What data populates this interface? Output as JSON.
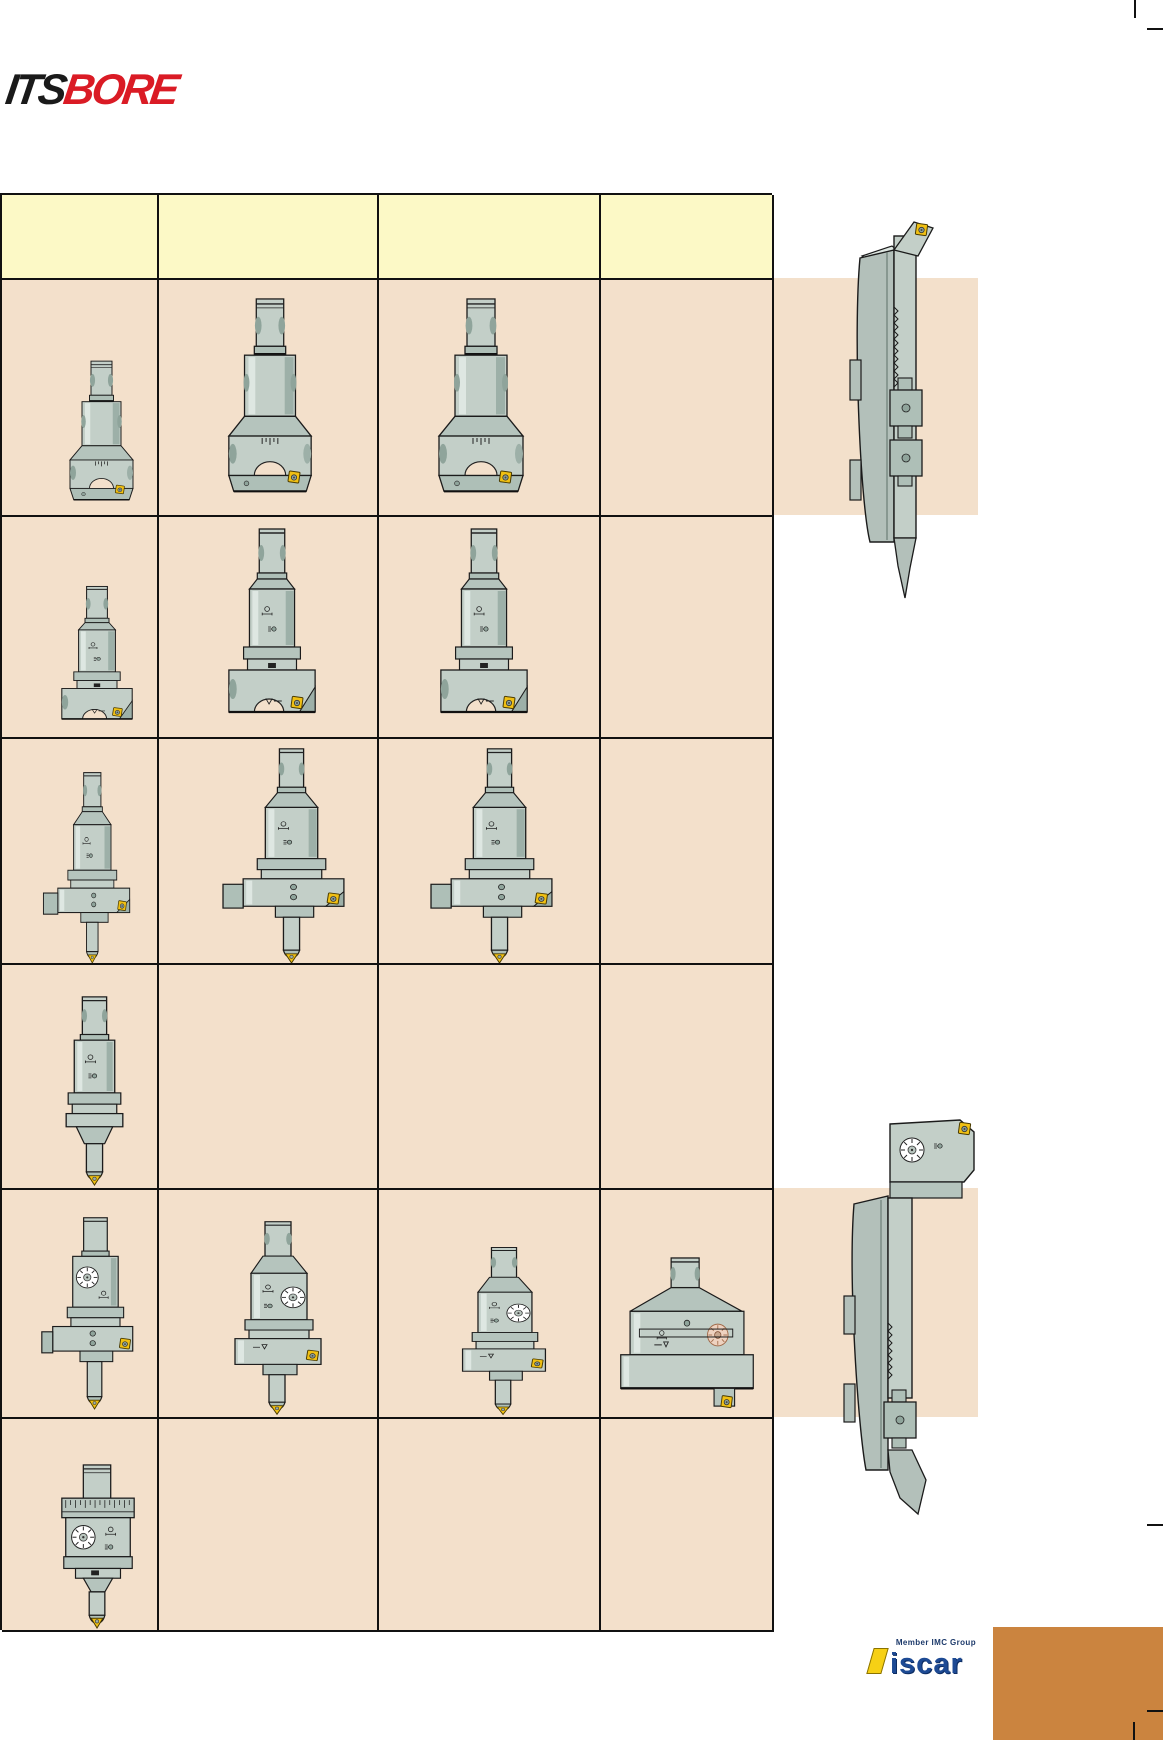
{
  "page": {
    "width": 1163,
    "height": 1740,
    "background": "#ffffff",
    "kind": "tool catalog page"
  },
  "brand": {
    "its": "ITS",
    "bore": "BORE",
    "its_color": "#1a1a1a",
    "bore_color": "#da1b25"
  },
  "header_row": {
    "columns": [
      "",
      "",
      "",
      ""
    ],
    "background": "#fcf9c6"
  },
  "grid": {
    "cell_background": "#f3e0cb",
    "rows": [
      {
        "cells": [
          "rough-boring-head-small",
          "rough-boring-head-medium",
          "rough-boring-head-large",
          null
        ]
      },
      {
        "cells": [
          "semi-finish-boring-head-small",
          "semi-finish-boring-head-medium",
          "semi-finish-boring-head-large",
          null
        ]
      },
      {
        "cells": [
          "boring-head-with-side-arm-and-bar-small",
          "boring-head-with-side-arm-and-bar-medium",
          "boring-head-with-side-arm-and-bar-large",
          null
        ]
      },
      {
        "cells": [
          "slim-boring-head-with-bar",
          null,
          null,
          null
        ]
      },
      {
        "cells": [
          "fine-boring-head-dial-with-arm",
          "fine-boring-head-dial-medium",
          "fine-boring-head-dial-large",
          "fine-boring-head-dial-wide"
        ]
      },
      {
        "cells": [
          "fine-boring-head-graduated-dial",
          null,
          null,
          null
        ]
      }
    ]
  },
  "right_panel": {
    "upper_tool": "boring-bar-side-view-with-insert-top",
    "lower_tool": "boring-bar-side-view-with-dial-head-bottom",
    "band_color": "#f3e0cb"
  },
  "footer": {
    "member_label": "Member IMC Group",
    "iscar_label": "iscar",
    "orange_block_color": "#cb843f"
  },
  "colors": {
    "header_yellow": "#fcf9c6",
    "cell_tan": "#f3e0cb",
    "tool_body": "#c3cfc8",
    "tool_shadow": "#9db0a8",
    "tool_dark": "#7f948c",
    "insert_yellow": "#f0c013",
    "iscar_blue": "#1d4a94",
    "logo_red": "#da1b25",
    "orange": "#cb843f"
  }
}
